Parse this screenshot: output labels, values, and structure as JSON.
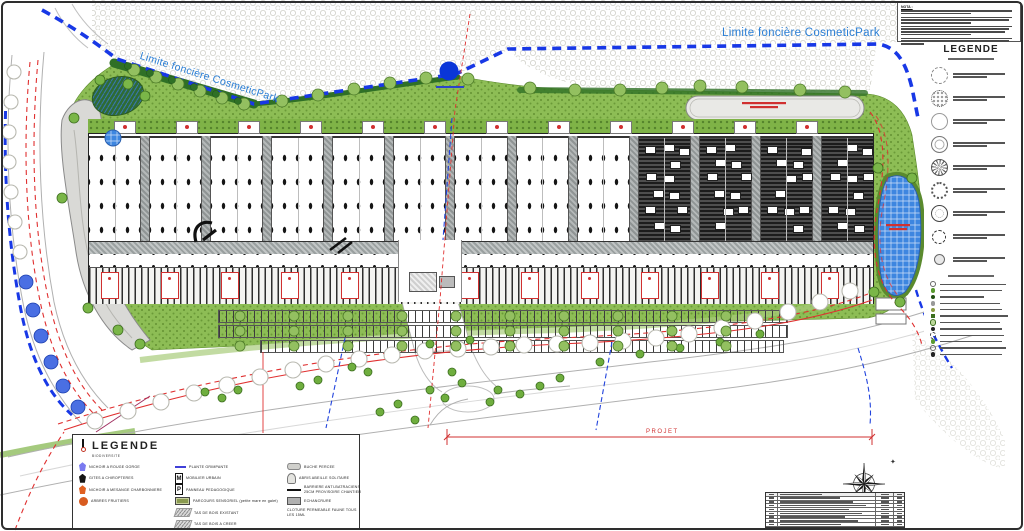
{
  "labels": {
    "boundary_top": "Limite foncière CosmeticPark",
    "boundary_left": "Limite foncière CosmeticPark",
    "project": "PROJET"
  },
  "notes": {
    "heading": "NOTA :",
    "paragraph_lines": [
      2,
      3,
      4,
      3
    ]
  },
  "colors": {
    "boundary_blue": "#1838e6",
    "road_red": "#e03030",
    "grass_green": "#8dbd55",
    "label_blue": "#2b7fd6",
    "basin_blue": "#3d86e0"
  },
  "legend_right": {
    "title": "LEGENDE",
    "tree_items": [
      {
        "icon": "tree-dashed-outline"
      },
      {
        "icon": "tree-flower-cluster"
      },
      {
        "icon": "tree-outline-light"
      },
      {
        "icon": "tree-double-ring"
      },
      {
        "icon": "tree-ray-hatch"
      },
      {
        "icon": "tree-dotted-large"
      },
      {
        "icon": "tree-target-ring"
      },
      {
        "icon": "tree-dashed-small"
      },
      {
        "icon": "tree-gray-disc"
      }
    ],
    "small_items": [
      {
        "icon": "dot-outline"
      },
      {
        "icon": "dot-green"
      },
      {
        "icon": "dot-darkgreen"
      },
      {
        "icon": "dot-gray"
      },
      {
        "icon": "dot-olive"
      },
      {
        "icon": "square-green"
      },
      {
        "icon": "dot-pale"
      },
      {
        "icon": "dot-black"
      },
      {
        "icon": "dot-dashed"
      },
      {
        "icon": "dot-green"
      },
      {
        "icon": "dot-outline"
      },
      {
        "icon": "dot-black"
      }
    ]
  },
  "legend_bio": {
    "title": "LEGENDE",
    "subtitle": "BIODIVERSITE",
    "columns": [
      [
        {
          "icon": "nichoir-blue",
          "label": "NICHOIR A ROUGE GORGE"
        },
        {
          "icon": "gite-black",
          "label": "GITES A CHIROPTERES"
        },
        {
          "icon": "nichoir-orange",
          "label": "NICHOIR A MESANGE CHARBONNIERE"
        },
        {
          "icon": "circle-orange",
          "label": "ARBRES FRUITIERS"
        }
      ],
      [
        {
          "icon": "line-blue",
          "label": "PLANTE GRIMPANTE"
        },
        {
          "icon": "box-letter",
          "letter": "M",
          "label": "MOBILIER URBAIN"
        },
        {
          "icon": "box-letter",
          "letter": "P",
          "label": "PANNEAU PEDAGOGIQUE"
        },
        {
          "icon": "rect-green",
          "label": "PARCOURS SENSORIEL (petite mare en galet)"
        },
        {
          "icon": "woodpile",
          "label": "TAS DE BOIS EXISTANT"
        },
        {
          "icon": "woodpile",
          "label": "TAS DE BOIS A CREER"
        }
      ],
      [
        {
          "icon": "log",
          "label": "BUCHE PERCEE"
        },
        {
          "icon": "hive",
          "label": "ABRIS ABEILLE SOLITAIRE"
        },
        {
          "icon": "line-black",
          "label": "BARRIERE ANTI-BATRACIENS 25CM PROVISOIRE CHANTIER"
        },
        {
          "icon": "rect-gray",
          "label": "ECHANCRURE"
        },
        {
          "icon": "none",
          "label": "CLOTURE PERMEABLE FAUNE TOUS LES 15ML"
        }
      ]
    ]
  },
  "building": {
    "bays": [
      {
        "type": "white"
      },
      {
        "type": "white"
      },
      {
        "type": "white"
      },
      {
        "type": "white"
      },
      {
        "type": "white"
      },
      {
        "type": "white"
      },
      {
        "type": "white"
      },
      {
        "type": "white"
      },
      {
        "type": "white"
      },
      {
        "type": "dark"
      },
      {
        "type": "dark"
      },
      {
        "type": "dark"
      },
      {
        "type": "dark"
      }
    ],
    "roof_panels": 12,
    "dock_panels": 13
  },
  "map": {
    "trees": {
      "verge_white": [
        [
          95,
          421
        ],
        [
          128,
          411
        ],
        [
          161,
          402
        ],
        [
          194,
          393
        ],
        [
          227,
          385
        ],
        [
          260,
          377
        ],
        [
          293,
          370
        ],
        [
          326,
          364
        ],
        [
          359,
          359
        ],
        [
          392,
          355
        ],
        [
          425,
          351
        ],
        [
          458,
          349
        ],
        [
          491,
          347
        ],
        [
          524,
          345
        ],
        [
          557,
          344
        ],
        [
          590,
          343
        ],
        [
          623,
          341
        ],
        [
          656,
          338
        ],
        [
          689,
          334
        ],
        [
          722,
          328
        ],
        [
          755,
          321
        ],
        [
          788,
          312
        ],
        [
          820,
          302
        ],
        [
          850,
          291
        ]
      ],
      "left_white": [
        [
          14,
          72
        ],
        [
          11,
          102
        ],
        [
          9,
          132
        ],
        [
          9,
          162
        ],
        [
          11,
          192
        ],
        [
          15,
          222
        ],
        [
          20,
          252
        ]
      ],
      "left_blue": [
        [
          26,
          282
        ],
        [
          33,
          310
        ],
        [
          41,
          336
        ],
        [
          51,
          362
        ],
        [
          63,
          386
        ],
        [
          78,
          407
        ]
      ],
      "hedge_green": [
        [
          134,
          70
        ],
        [
          156,
          77
        ],
        [
          178,
          84
        ],
        [
          200,
          91
        ],
        [
          222,
          98
        ],
        [
          244,
          104
        ],
        [
          282,
          101
        ],
        [
          318,
          95
        ],
        [
          354,
          89
        ],
        [
          390,
          83
        ],
        [
          426,
          78
        ],
        [
          468,
          79
        ],
        [
          530,
          88
        ],
        [
          575,
          90
        ],
        [
          620,
          90
        ],
        [
          662,
          88
        ],
        [
          700,
          86
        ],
        [
          742,
          87
        ],
        [
          800,
          90
        ],
        [
          845,
          92
        ]
      ],
      "dark_bush": [
        [
          128,
          66
        ],
        [
          150,
          73
        ],
        [
          172,
          80
        ],
        [
          194,
          87
        ],
        [
          216,
          94
        ],
        [
          238,
          101
        ]
      ],
      "scatter_green": [
        [
          205,
          392
        ],
        [
          222,
          398
        ],
        [
          238,
          390
        ],
        [
          300,
          386
        ],
        [
          318,
          380
        ],
        [
          352,
          367
        ],
        [
          368,
          372
        ],
        [
          398,
          404
        ],
        [
          430,
          390
        ],
        [
          445,
          398
        ],
        [
          452,
          372
        ],
        [
          462,
          383
        ],
        [
          490,
          402
        ],
        [
          498,
          390
        ],
        [
          520,
          394
        ],
        [
          540,
          386
        ],
        [
          560,
          378
        ],
        [
          600,
          362
        ],
        [
          640,
          354
        ],
        [
          680,
          348
        ],
        [
          720,
          342
        ],
        [
          760,
          334
        ],
        [
          470,
          340
        ],
        [
          430,
          344
        ],
        [
          415,
          420
        ],
        [
          380,
          412
        ]
      ],
      "basin_side": [
        [
          878,
          168
        ],
        [
          912,
          178
        ],
        [
          874,
          292
        ],
        [
          900,
          302
        ],
        [
          74,
          118
        ],
        [
          62,
          198
        ],
        [
          88,
          308
        ],
        [
          118,
          330
        ],
        [
          140,
          344
        ],
        [
          100,
          80
        ],
        [
          128,
          84
        ],
        [
          145,
          96
        ]
      ]
    },
    "parking": {
      "rows_y": [
        310,
        325,
        340
      ],
      "x0": 218,
      "x1": 786,
      "tree_step": 54
    }
  },
  "revtable": {
    "rows": 8
  }
}
